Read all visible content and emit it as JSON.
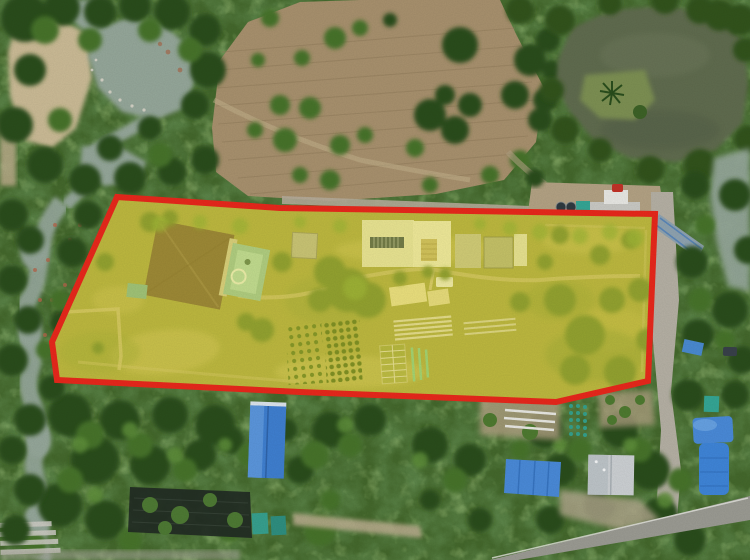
{
  "meta": {
    "type": "aerial-drone-photo",
    "description": "Aerial drone photograph of a rural land plot outlined with a thick red boundary and shaded translucent yellow; surrounded by a winding river on the left, a brown orchard field on top, a pond at top right, a vertical road and canal on the right, and dense trees with blue-roofed farm buildings along the bottom.",
    "width": 750,
    "height": 560
  },
  "colors": {
    "boundary_red": "#e8281c",
    "parcel_highlight": "#e8da2e",
    "parcel_grass": "#a3a44b",
    "base_green": "#44682c",
    "deep_tree": "#2c4d1e",
    "mid_tree": "#477329",
    "light_tree": "#5f8f3a",
    "river_water": "#95a79a",
    "pond_water": "#616c50",
    "field_tan": "#a8916e",
    "sand": "#cbbb96",
    "dirt_path": "#b3a284",
    "road_gray": "#b5b0a4",
    "asphalt_road": "#9b9b93",
    "bridge_deck": "#8fa3b0",
    "house_roof": "#70583c",
    "house_roof_light": "#7d6648",
    "pool_teal": "#8fc6b2",
    "pool_inner": "#aadcca",
    "workshop_white": "#e9e8cf",
    "workshop_white2": "#f2f1da",
    "solar_blue": "#2d4358",
    "shed_cream": "#ece2ae",
    "blue_roof": "#3f7fd0",
    "blue_tarp": "#4a8ad8",
    "teal_roof": "#35a695",
    "gray_roof": "#ccd0d3",
    "shade_net": "#222b24",
    "red_car": "#c23227",
    "white_van": "#f4f4ec"
  },
  "parcel": {
    "points": "117,197 280,208 530,212 655,214 648,381 556,402 300,392 57,380 52,342",
    "stroke_width": 6,
    "highlight_opacity": 0.38
  }
}
